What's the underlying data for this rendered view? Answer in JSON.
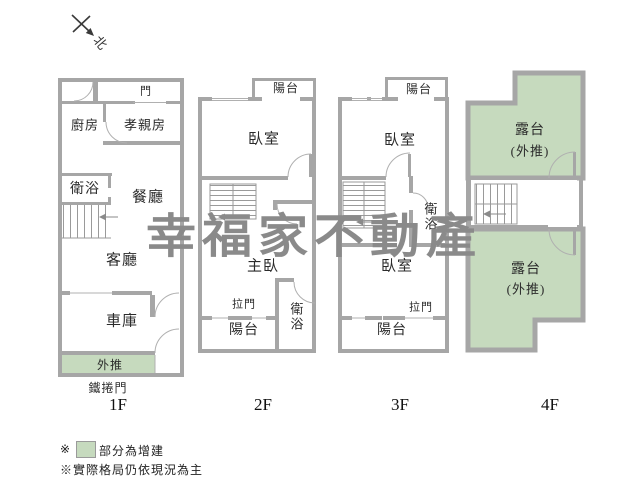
{
  "compass": {
    "north_label": "北"
  },
  "watermark": {
    "text": "幸福家不動產",
    "color": "#8a8a8a"
  },
  "colors": {
    "wall": "#a6a6a6",
    "addition_green": "#c6dabe",
    "thin_line": "#b0b0b0",
    "text": "#2b2b2b"
  },
  "floors": [
    {
      "name": "1F",
      "floor_label": "1F",
      "gate_label": "鐵捲門",
      "rooms": [
        {
          "name": "entry-door",
          "label": "門"
        },
        {
          "name": "kitchen",
          "label": "廚房"
        },
        {
          "name": "parents-room",
          "label": "孝親房"
        },
        {
          "name": "bathroom",
          "label": "衛浴"
        },
        {
          "name": "dining-room",
          "label": "餐廳"
        },
        {
          "name": "living-room",
          "label": "客廳"
        },
        {
          "name": "garage",
          "label": "車庫"
        },
        {
          "name": "push-out",
          "label": "外推"
        }
      ]
    },
    {
      "name": "2F",
      "floor_label": "2F",
      "rooms": [
        {
          "name": "balcony-top",
          "label": "陽台"
        },
        {
          "name": "bedroom",
          "label": "臥室"
        },
        {
          "name": "master-bedroom",
          "label": "主臥"
        },
        {
          "name": "sliding-door",
          "label": "拉門"
        },
        {
          "name": "bathroom",
          "label": "衛浴"
        },
        {
          "name": "balcony-bottom",
          "label": "陽台"
        }
      ]
    },
    {
      "name": "3F",
      "floor_label": "3F",
      "rooms": [
        {
          "name": "balcony-top",
          "label": "陽台"
        },
        {
          "name": "bedroom-upper",
          "label": "臥室"
        },
        {
          "name": "bathroom",
          "label": "衛浴"
        },
        {
          "name": "bedroom-lower",
          "label": "臥室"
        },
        {
          "name": "sliding-door",
          "label": "拉門"
        },
        {
          "name": "balcony-bottom",
          "label": "陽台"
        }
      ]
    },
    {
      "name": "4F",
      "floor_label": "4F",
      "rooms": [
        {
          "name": "terrace-upper",
          "label": "露台"
        },
        {
          "name": "terrace-upper-note",
          "label": "(外推)"
        },
        {
          "name": "terrace-lower",
          "label": "露台"
        },
        {
          "name": "terrace-lower-note",
          "label": "(外推)"
        }
      ]
    }
  ],
  "legend": {
    "line1_marker": "※",
    "line1_text": "部分為增建",
    "line2_text": "※實際格局仍依現況為主"
  }
}
